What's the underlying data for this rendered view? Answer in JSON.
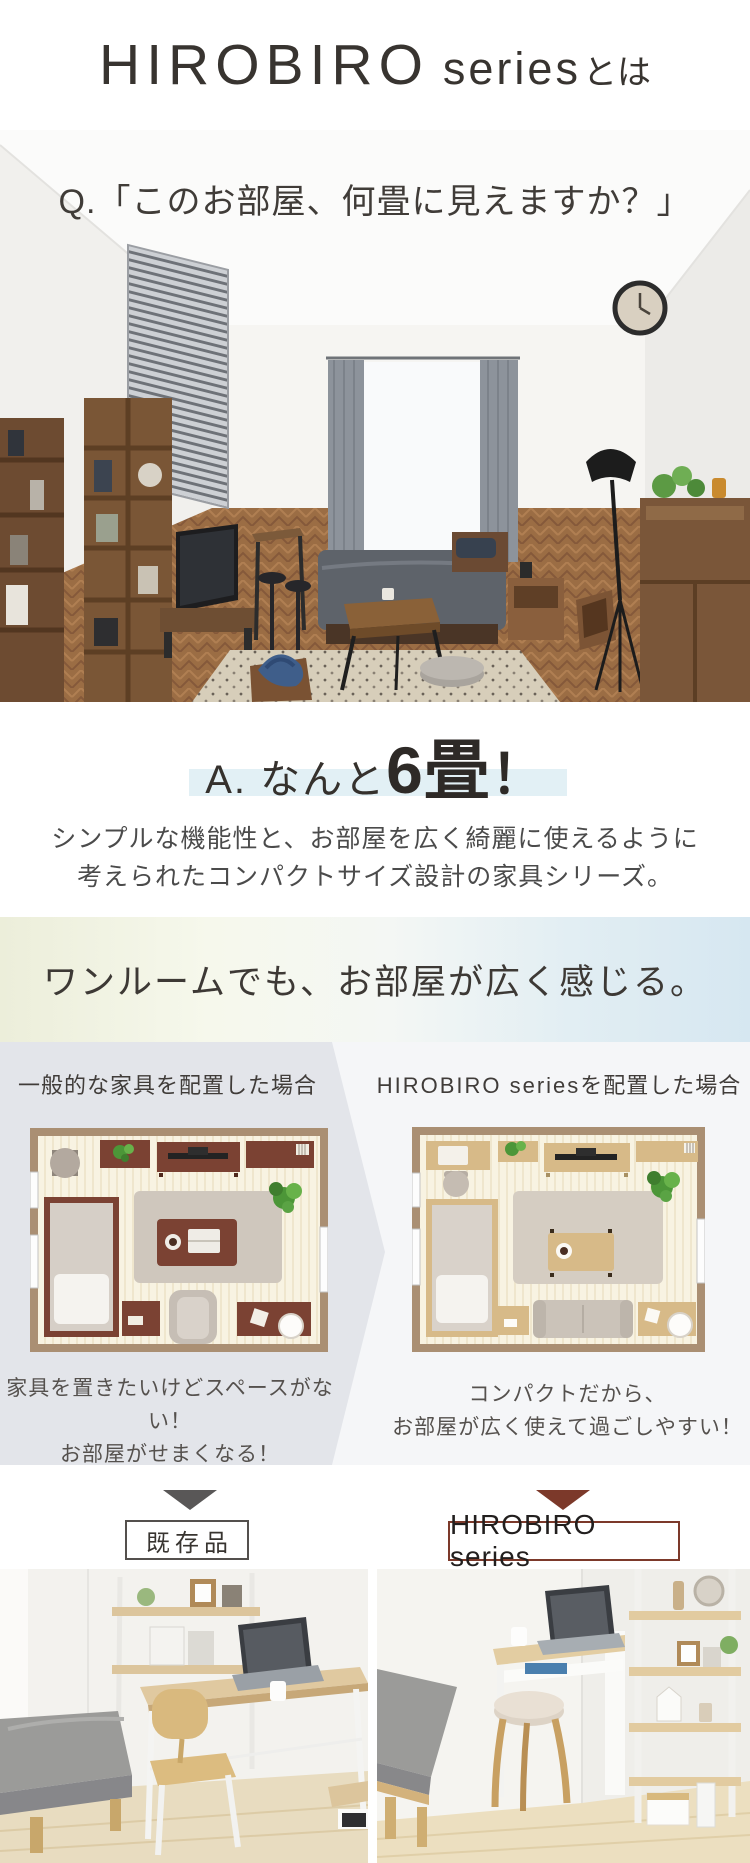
{
  "header": {
    "brand": "HIROBIRO",
    "brand_sub": "series",
    "suffix_ja": "とは"
  },
  "question": {
    "text": "Q.「このお部屋、何畳に見えますか？」"
  },
  "answer": {
    "prefix": "A. なんと",
    "big": "6畳",
    "exclamation": "！"
  },
  "description": {
    "line1": "シンプルな機能性と、お部屋を広く綺麗に使えるように",
    "line2": "考えられたコンパクトサイズ設計の家具シリーズ。"
  },
  "banner": {
    "text": "ワンルームでも、お部屋が広く感じる。"
  },
  "comparison": {
    "left": {
      "heading": "一般的な家具を配置した場合",
      "caption1": "家具を置きたいけどスペースがない！",
      "caption2": "お部屋がせまくなる！"
    },
    "right": {
      "heading_brand": "HIROBIRO series",
      "heading_suffix": "を配置した場合",
      "caption1": "コンパクトだから、",
      "caption2": "お部屋が広く使えて過ごしやすい！"
    }
  },
  "tags": {
    "left_label": "既存品",
    "right_label": "HIROBIRO series"
  },
  "colors": {
    "accent_maroon": "#7c392a",
    "accent_gray": "#595757",
    "highlight_blue": "#e2f0f5",
    "banner_gradient_left": "#eceeda",
    "banner_gradient_right": "#d6e7f1",
    "compare_panel_gray": "#e3e5ea",
    "compare_bg": "#f5f6f8",
    "plan_dark_furniture": "#7b4233",
    "plan_light_furniture": "#d7ba88"
  }
}
